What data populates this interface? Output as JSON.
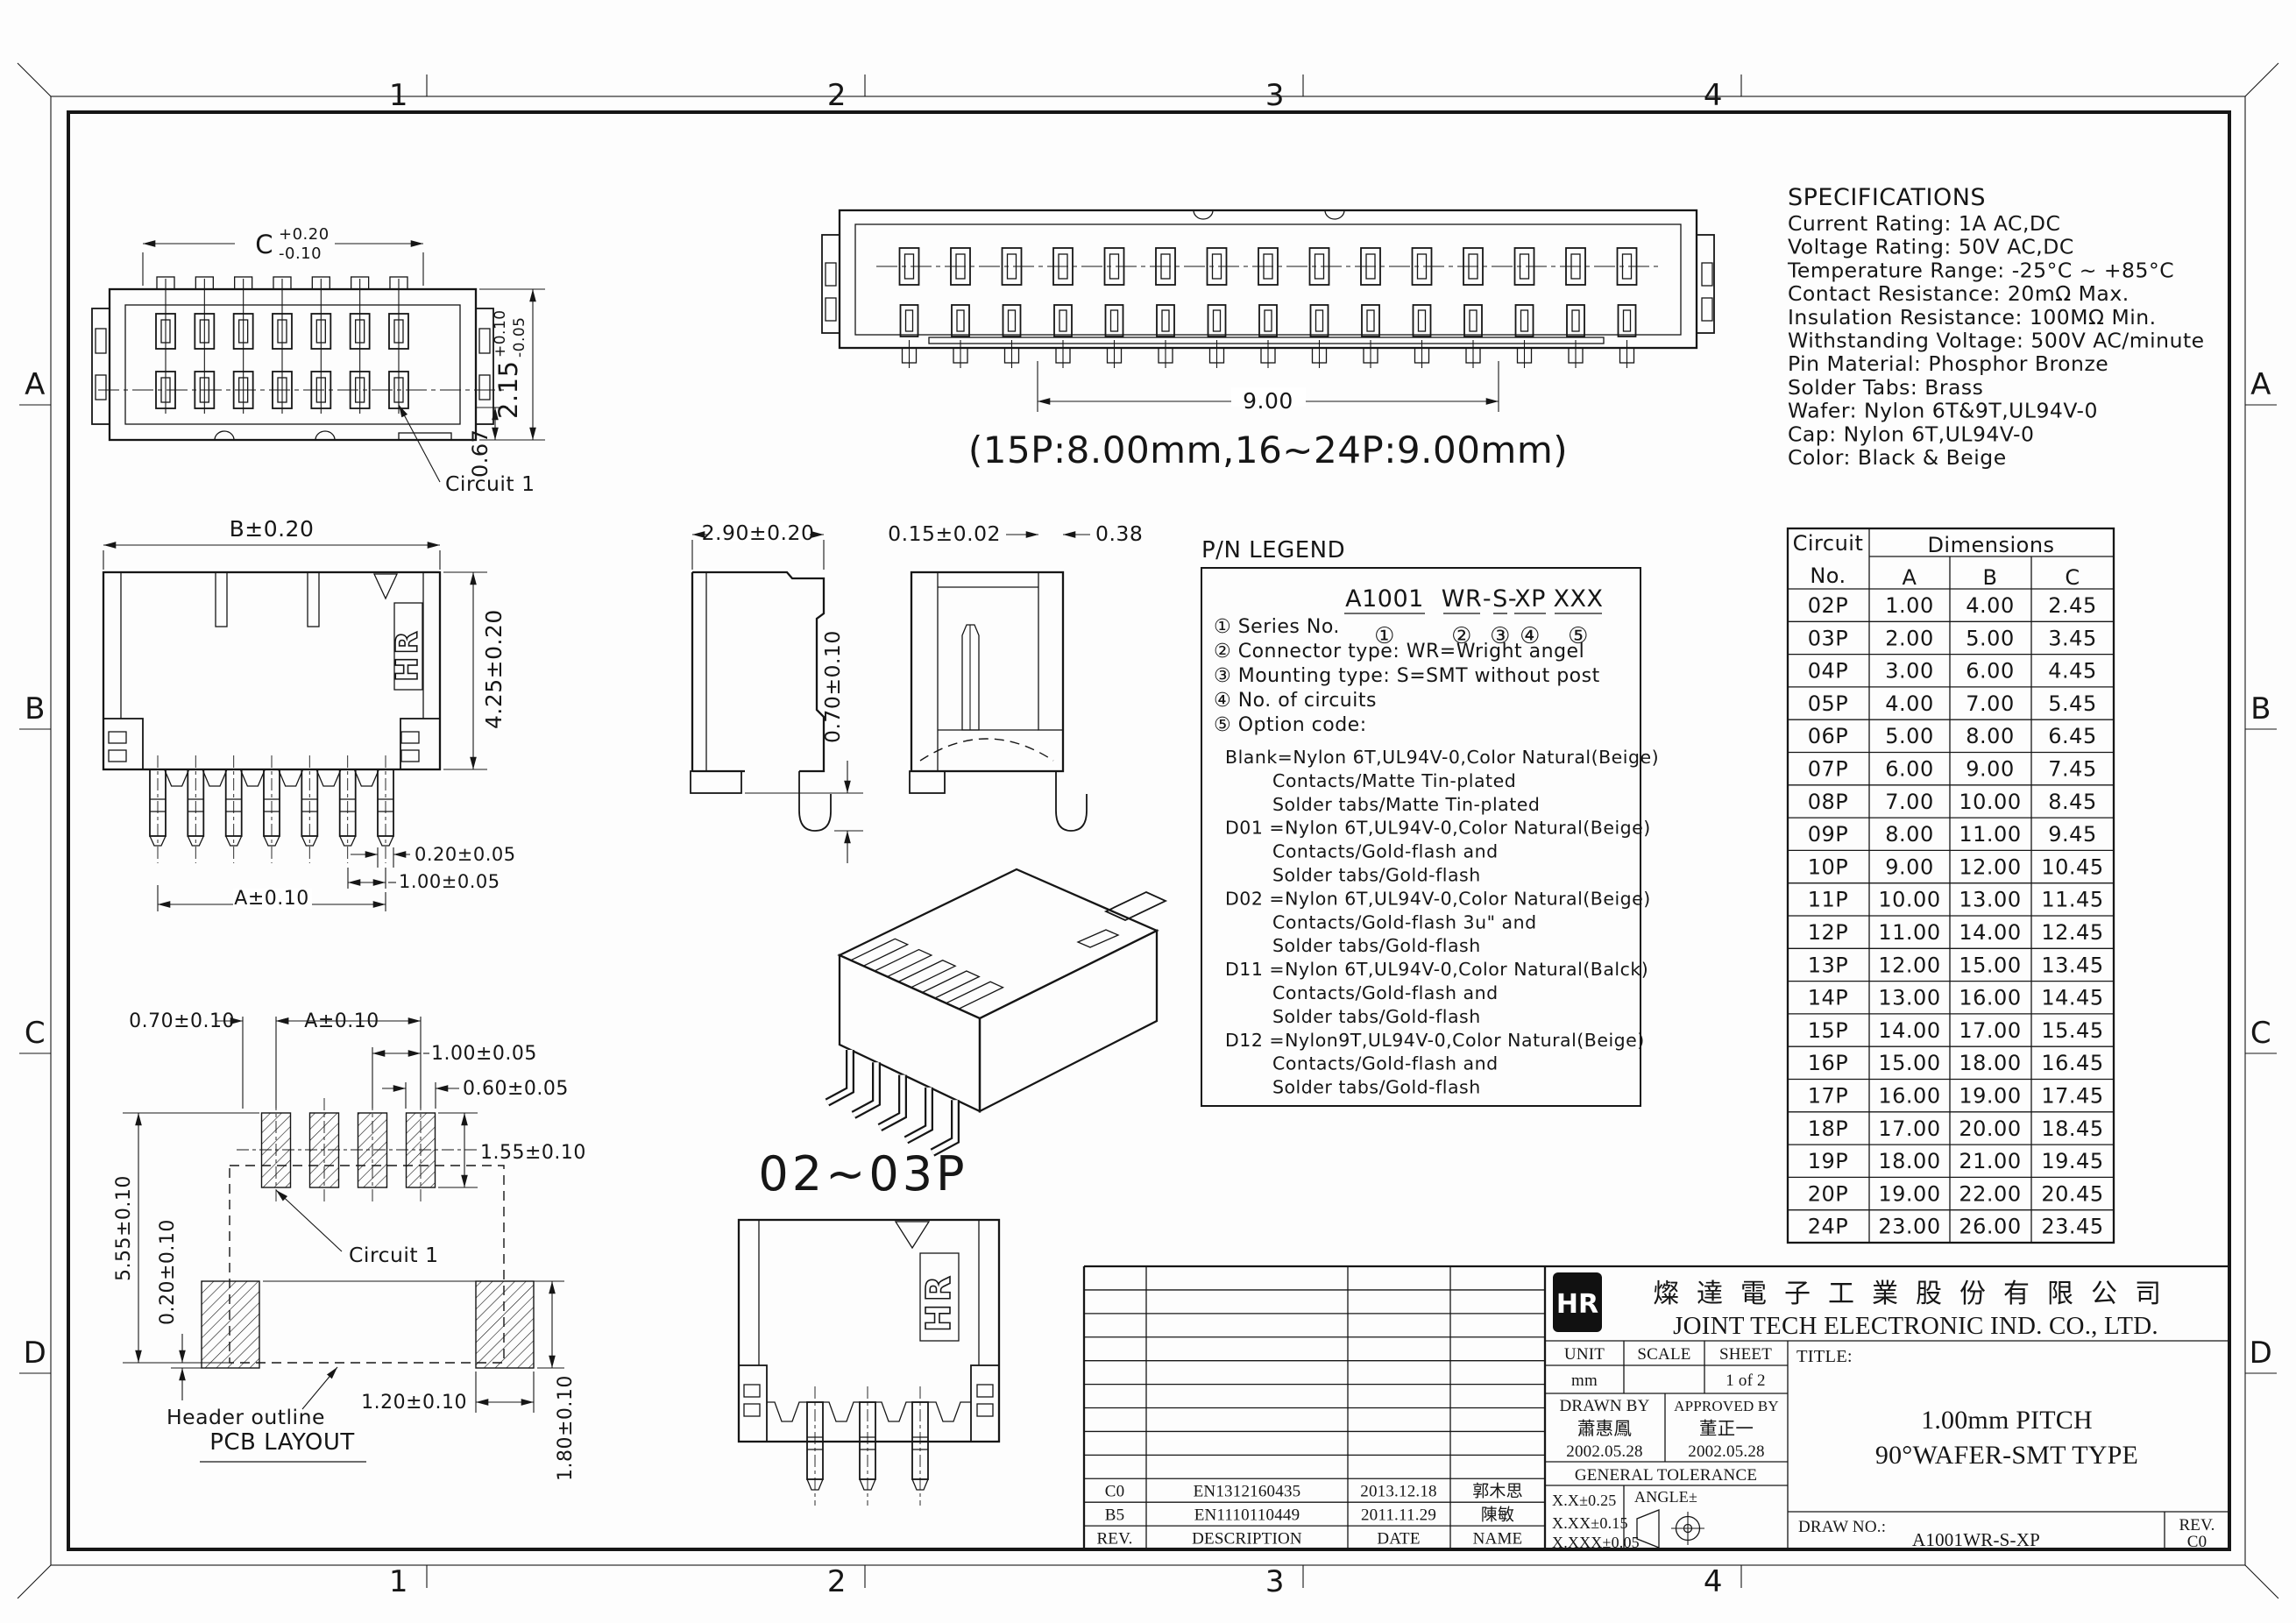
{
  "sheet": {
    "zones_top": [
      "1",
      "2",
      "3",
      "4"
    ],
    "zones_bottom": [
      "1",
      "2",
      "3",
      "4"
    ],
    "zones_left": [
      "A",
      "B",
      "C",
      "D"
    ],
    "zones_right": [
      "A",
      "B",
      "C",
      "D"
    ]
  },
  "specifications": {
    "title": "SPECIFICATIONS",
    "lines": [
      "Current Rating: 1A AC,DC",
      "Voltage Rating: 50V AC,DC",
      "Temperature Range: -25°C ~ +85°C",
      "Contact Resistance: 20mΩ Max.",
      "Insulation Resistance: 100MΩ Min.",
      "Withstanding Voltage: 500V AC/minute",
      "Pin Material: Phosphor Bronze",
      "Solder Tabs: Brass",
      "Wafer: Nylon 6T&9T,UL94V-0",
      "Cap: Nylon 6T,UL94V-0",
      "Color: Black & Beige"
    ]
  },
  "top_view": {
    "dim_width": "C",
    "tol_up": "+0.20",
    "tol_dn": "-0.10",
    "dim_height": "2.15",
    "h_tol_up": "+0.10",
    "h_tol_dn": "-0.05",
    "dim_tab": "0.67",
    "circuit": "Circuit 1"
  },
  "long_view": {
    "dim": "9.00",
    "note": "(15P:8.00mm,16~24P:9.00mm)"
  },
  "front_view": {
    "dim_b": "B±0.20",
    "dim_h": "4.25±0.20",
    "dim_tab": "0.20±0.05",
    "dim_pitch": "1.00±0.05",
    "dim_a": "A±0.10",
    "logo": "HR"
  },
  "side_view": {
    "dim_w": "2.90±0.20",
    "dim_foot": "0.70±0.10"
  },
  "section_view": {
    "dim_wall": "0.15±0.02",
    "dim_gap": "0.38"
  },
  "pn_legend": {
    "title": "P/N LEGEND",
    "segments": [
      "A1001",
      "WR",
      "S",
      "XP",
      "XXX"
    ],
    "seps": [
      "-",
      "-"
    ],
    "circles": [
      "①",
      "②",
      "③",
      "④",
      "⑤"
    ],
    "items": [
      "① Series No.",
      "② Connector type: WR=Wright angel",
      "③ Mounting type: S=SMT without post",
      "④ No. of circuits",
      "⑤ Option code:"
    ],
    "options": [
      {
        "t": "Blank=Nylon 6T,UL94V-0,Color Natural(Beige)",
        "i": 0
      },
      {
        "t": "Contacts/Matte Tin-plated",
        "i": 1
      },
      {
        "t": "Solder tabs/Matte Tin-plated",
        "i": 1
      },
      {
        "t": "D01 =Nylon 6T,UL94V-0,Color Natural(Beige)",
        "i": 0
      },
      {
        "t": "Contacts/Gold-flash and",
        "i": 1
      },
      {
        "t": "Solder tabs/Gold-flash",
        "i": 1
      },
      {
        "t": "D02 =Nylon 6T,UL94V-0,Color Natural(Beige)",
        "i": 0
      },
      {
        "t": "Contacts/Gold-flash 3u\" and",
        "i": 1
      },
      {
        "t": "Solder tabs/Gold-flash",
        "i": 1
      },
      {
        "t": "D11 =Nylon 6T,UL94V-0,Color Natural(Balck)",
        "i": 0
      },
      {
        "t": "Contacts/Gold-flash and",
        "i": 1
      },
      {
        "t": "Solder tabs/Gold-flash",
        "i": 1
      },
      {
        "t": "D12 =Nylon9T,UL94V-0,Color Natural(Beige)",
        "i": 0
      },
      {
        "t": "Contacts/Gold-flash and",
        "i": 1
      },
      {
        "t": "Solder tabs/Gold-flash",
        "i": 1
      }
    ]
  },
  "dim_table": {
    "h_circuit": "Circuit",
    "h_no": "No.",
    "h_dim": "Dimensions",
    "h_a": "A",
    "h_b": "B",
    "h_c": "C",
    "rows": [
      [
        "02P",
        "1.00",
        "4.00",
        "2.45"
      ],
      [
        "03P",
        "2.00",
        "5.00",
        "3.45"
      ],
      [
        "04P",
        "3.00",
        "6.00",
        "4.45"
      ],
      [
        "05P",
        "4.00",
        "7.00",
        "5.45"
      ],
      [
        "06P",
        "5.00",
        "8.00",
        "6.45"
      ],
      [
        "07P",
        "6.00",
        "9.00",
        "7.45"
      ],
      [
        "08P",
        "7.00",
        "10.00",
        "8.45"
      ],
      [
        "09P",
        "8.00",
        "11.00",
        "9.45"
      ],
      [
        "10P",
        "9.00",
        "12.00",
        "10.45"
      ],
      [
        "11P",
        "10.00",
        "13.00",
        "11.45"
      ],
      [
        "12P",
        "11.00",
        "14.00",
        "12.45"
      ],
      [
        "13P",
        "12.00",
        "15.00",
        "13.45"
      ],
      [
        "14P",
        "13.00",
        "16.00",
        "14.45"
      ],
      [
        "15P",
        "14.00",
        "17.00",
        "15.45"
      ],
      [
        "16P",
        "15.00",
        "18.00",
        "16.45"
      ],
      [
        "17P",
        "16.00",
        "19.00",
        "17.45"
      ],
      [
        "18P",
        "17.00",
        "20.00",
        "18.45"
      ],
      [
        "19P",
        "18.00",
        "21.00",
        "19.45"
      ],
      [
        "20P",
        "19.00",
        "22.00",
        "20.45"
      ],
      [
        "24P",
        "23.00",
        "26.00",
        "23.45"
      ]
    ]
  },
  "pcb": {
    "d_offset": "0.70±0.10",
    "d_a": "A±0.10",
    "d_pitch": "1.00±0.05",
    "d_pad_w": "0.60±0.05",
    "d_pad_h": "1.55±0.10",
    "d_height": "5.55±0.10",
    "d_gap": "0.20±0.10",
    "d_tab_w": "1.20±0.10",
    "d_tab_h": "1.80±0.10",
    "circuit": "Circuit 1",
    "header_outline": "Header outline",
    "title": "PCB LAYOUT"
  },
  "variant": {
    "label": "02~03P",
    "logo": "HR"
  },
  "title_block": {
    "logo": "HR",
    "company_cn": "燦達電子工業股份有限公司",
    "company_en": "JOINT TECH ELECTRONIC IND. CO., LTD.",
    "unit_label": "UNIT",
    "unit_value": "mm",
    "scale_label": "SCALE",
    "scale_value": "",
    "sheet_label": "SHEET",
    "sheet_value": "1 of 2",
    "title_label": "TITLE:",
    "title_line1": "1.00mm PITCH",
    "title_line2": "90°WAFER-SMT TYPE",
    "drawn_label": "DRAWN BY",
    "drawn_name": "蕭惠鳳",
    "drawn_date": "2002.05.28",
    "approved_label": "APPROVED BY",
    "approved_name": "董正一",
    "approved_date": "2002.05.28",
    "general_tolerance": "GENERAL TOLERANCE",
    "tol1": "X.X±0.25",
    "tol2": "X.XX±0.15",
    "tol3": "X.XXX±0.05",
    "angle_label": "ANGLE±",
    "draw_no_label": "DRAW NO.:",
    "draw_no_value": "A1001WR-S-XP",
    "rev_label": "REV.",
    "rev_value": "C0"
  },
  "revision_table": {
    "headers": [
      "REV.",
      "DESCRIPTION",
      "DATE",
      "NAME"
    ],
    "rows": [
      [
        "C0",
        "EN1312160435",
        "2013.12.18",
        "郭木思"
      ],
      [
        "B5",
        "EN1110110449",
        "2011.11.29",
        "陳敏"
      ]
    ]
  }
}
